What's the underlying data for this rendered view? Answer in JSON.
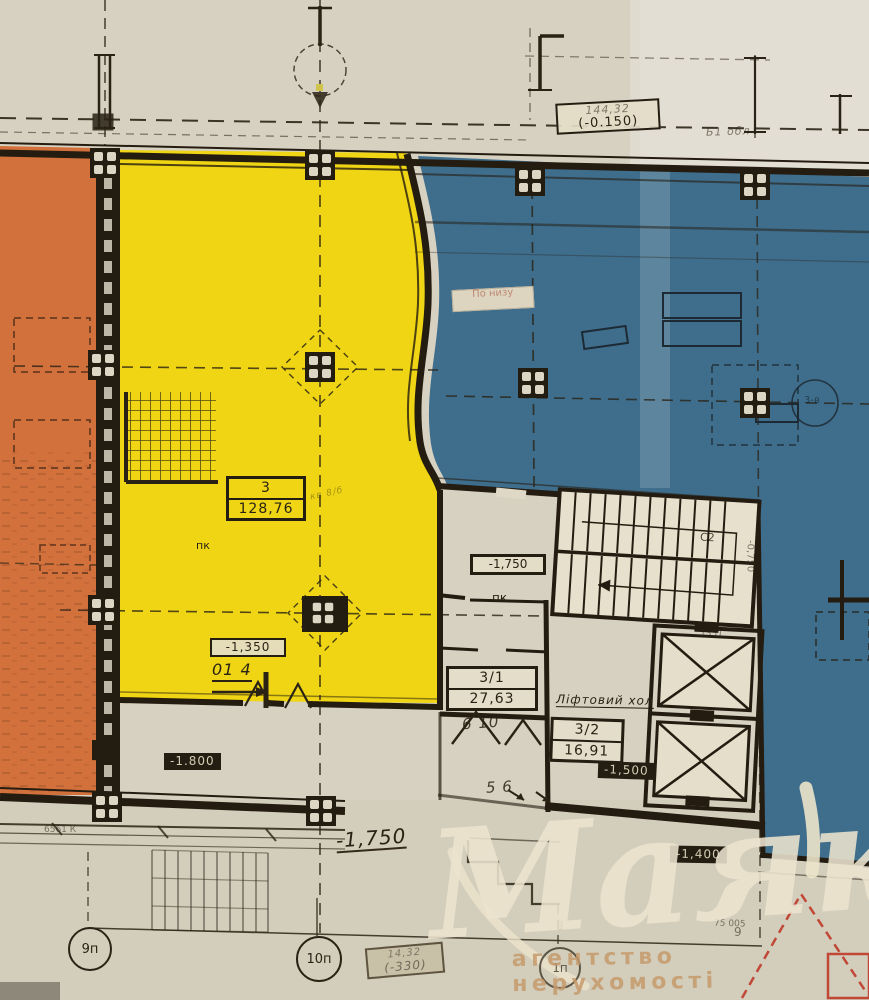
{
  "plan": {
    "top": {
      "elev_note": "144,32",
      "elev_value": "(-0.150)",
      "right_note": "Б1 обл"
    },
    "rooms": {
      "room3": {
        "number": "3",
        "area": "128,76",
        "side_note": "кв 8/б"
      },
      "room31": {
        "number": "3/1",
        "area": "27,63"
      },
      "room32": {
        "number": "3/2",
        "area": "16,91"
      },
      "lift_hall": "Ліфтовий хол"
    },
    "levels": {
      "minus1350": "-1,350",
      "minus1500": "-1,500",
      "minus1750_box": "-1,750",
      "minus1750_hand": "-1,750",
      "minus1800": "-1.800",
      "minus1400": "-1,400",
      "minus0750": "-0,750",
      "minus330_note": "14,32",
      "minus330": "(-330)"
    },
    "annotations": {
      "pk1": "пк",
      "pk2": "пк",
      "hand_014": "01 4",
      "hand_610": "6  10",
      "hand_56": "5  6",
      "c2": "С2",
      "dim_6561": "6561 К",
      "dim_75005": "75 005",
      "dim_1351": "1351",
      "grid8": "8",
      "grid9": "9",
      "circle_note": "3-в",
      "sticker": "По низу"
    },
    "grid_bubbles": [
      {
        "id": "9p",
        "label": "9п"
      },
      {
        "id": "10p",
        "label": "10п"
      },
      {
        "id": "1p",
        "label": "1п"
      }
    ]
  },
  "watermark": {
    "logo": "Маяк",
    "tagline": "агентство нерухомості"
  },
  "colors": {
    "orange": "#d2713c",
    "yellow": "#efd513",
    "blue": "#3f6e8d",
    "red": "#bf3a28",
    "paper": "#d7d1c2",
    "ink": "#2a2315",
    "watermark_cream": "#ece3ca",
    "tagline_tan": "#c49a6b"
  }
}
